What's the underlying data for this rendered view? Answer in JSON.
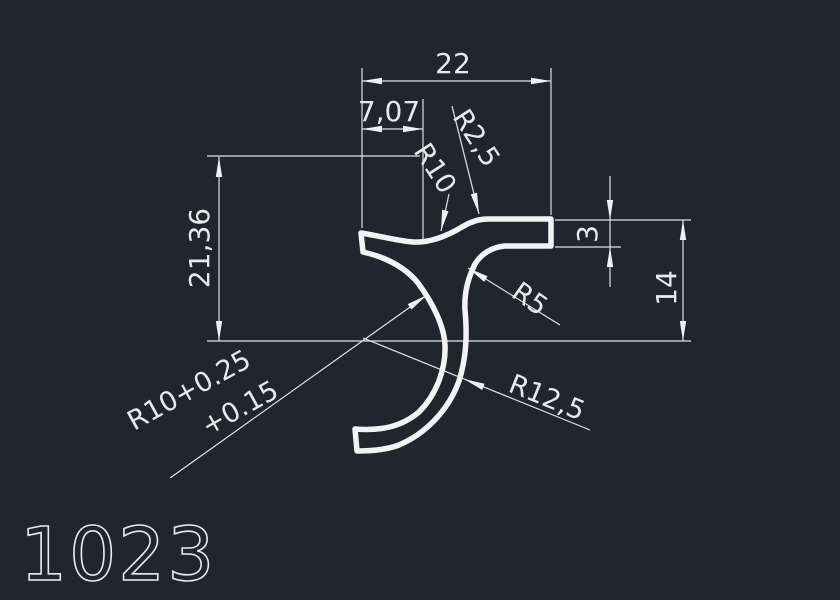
{
  "canvas": {
    "background_color": "#20262e",
    "line_color": "#e7eaed",
    "description": "CAD cross-section drawing of extrusion profile"
  },
  "drawing": {
    "part_number": "1023",
    "dimensions": {
      "overall_width": "22",
      "inner_width": "7,07",
      "left_height": "21,36",
      "bar_thickness": "3",
      "right_height": "14"
    },
    "radius_labels": {
      "fillet_small": "R2,5",
      "top_radius": "R10",
      "neck_fillet": "R5",
      "hook_outer_radius": "R12,5",
      "hook_inner_radius_line1": "R10+0.25",
      "hook_inner_radius_line2": "+0.15"
    }
  }
}
